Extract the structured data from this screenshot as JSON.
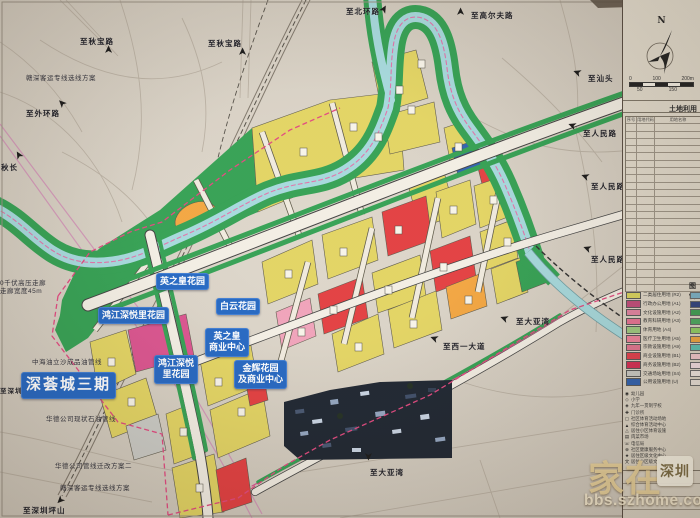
{
  "icons": {
    "arrow": "➤",
    "north": "N"
  },
  "colors": {
    "paper": "#d8d1c5",
    "residential_yellow": "#e2d35f",
    "commercial_red": "#e23a3c",
    "admin_magenta": "#d94f8c",
    "light_pink": "#efa0b8",
    "orange": "#f2a33c",
    "park_green": "#2f9e4f",
    "utility_blue": "#2b5eae",
    "river_cyan": "#a4d8dc",
    "boundary_dash_pink": "#e0447c",
    "label_blue": "#1f63c0"
  },
  "map": {
    "direction_labels": [
      {
        "text": "至秋宝路"
      },
      {
        "text": "至秋宝路"
      },
      {
        "text": "至外环路"
      },
      {
        "text": "秋长"
      },
      {
        "text": "至北环路"
      },
      {
        "text": "至高尔夫路"
      },
      {
        "text": "至汕头"
      },
      {
        "text": "至人民路"
      },
      {
        "text": "至人民路"
      },
      {
        "text": "至人民路"
      },
      {
        "text": "至大亚湾"
      },
      {
        "text": "至西一大道"
      },
      {
        "text": "至大亚湾"
      },
      {
        "text": "至深圳坪山"
      },
      {
        "text": "至深圳"
      }
    ],
    "annotations": [
      {
        "text": "赣深客运专线选线方案"
      },
      {
        "text": "0千伏高压走廊\n走廊宽度45m"
      },
      {
        "text": "中海油立沙成品油管线"
      },
      {
        "text": "华德公司现状石油管线"
      },
      {
        "text": "华德公司管线迁改方案二"
      },
      {
        "text": "赣深客运专线选线方案"
      }
    ],
    "project_labels": [
      {
        "text": "英之皇花园"
      },
      {
        "text": "鸿江深悦里花园"
      },
      {
        "text": "白云花园"
      },
      {
        "text": "英之皇\n商业中心"
      },
      {
        "text": "鸿江深悦\n里花园"
      },
      {
        "text": "金辉花园\n及商业中心"
      },
      {
        "text": "深荟城三期"
      }
    ]
  },
  "panel": {
    "north_label": "N",
    "scale": {
      "t0": "0",
      "t1": "100",
      "t2": "200m",
      "s0": "50",
      "s1": "150"
    },
    "table_title": "土地利用",
    "table_headers": [
      "序号",
      "用地代码",
      "用地名称"
    ],
    "legend_title": "图例",
    "land_use_legend": [
      {
        "label": "二类居住用地 (R2)",
        "color": "#d9d35a"
      },
      {
        "label": "行政办公用地 (A1)",
        "color": "#c04878"
      },
      {
        "label": "文化设施用地 (A2)",
        "color": "#e282a0"
      },
      {
        "label": "教育科研用地 (A3)",
        "color": "#e76f92"
      },
      {
        "label": "体育用地 (A4)",
        "color": "#9cc97e"
      },
      {
        "label": "医疗卫生用地 (A5)",
        "color": "#ee8099"
      },
      {
        "label": "宗教设施用地 (A9)",
        "color": "#e2738f"
      },
      {
        "label": "商业设施用地 (B1)",
        "color": "#e23b49"
      },
      {
        "label": "商务设施用地 (B2)",
        "color": "#d42a50"
      },
      {
        "label": "交通场站用地 (S4)",
        "color": "#c9c9c4"
      },
      {
        "label": "公用设施用地 (U)",
        "color": "#2b5eae"
      }
    ],
    "symbol_legend": [
      {
        "glyph": "◉",
        "label": "幼儿园"
      },
      {
        "glyph": "◇",
        "label": "小学"
      },
      {
        "glyph": "◈",
        "label": "九年一贯制学校"
      },
      {
        "glyph": "✚",
        "label": "门诊所"
      },
      {
        "glyph": "▢",
        "label": "社区体育活动场地"
      },
      {
        "glyph": "▲",
        "label": "综合体育活动中心"
      },
      {
        "glyph": "△",
        "label": "居住小区体育设施"
      },
      {
        "glyph": "▤",
        "label": "肉菜市场"
      },
      {
        "glyph": "☏",
        "label": "电信局"
      },
      {
        "glyph": "⊕",
        "label": "社区健康服务中心"
      },
      {
        "glyph": "★",
        "label": "居住区级文化中心"
      },
      {
        "glyph": "文",
        "label": "居住小区级文化站"
      }
    ],
    "right_column_swatches": [
      "#7ab2c8",
      "#2c3f7d",
      "#3c9e52",
      "#49a85e",
      "#8fce62",
      "#f0a43c",
      "#58bfb2",
      "#f2c6cc",
      "#f5dfe3",
      "#efe7e0",
      "#e8e0d8"
    ]
  },
  "watermark": {
    "part1": "家在",
    "seal": "深圳",
    "url": "bbs.szhome.com"
  }
}
